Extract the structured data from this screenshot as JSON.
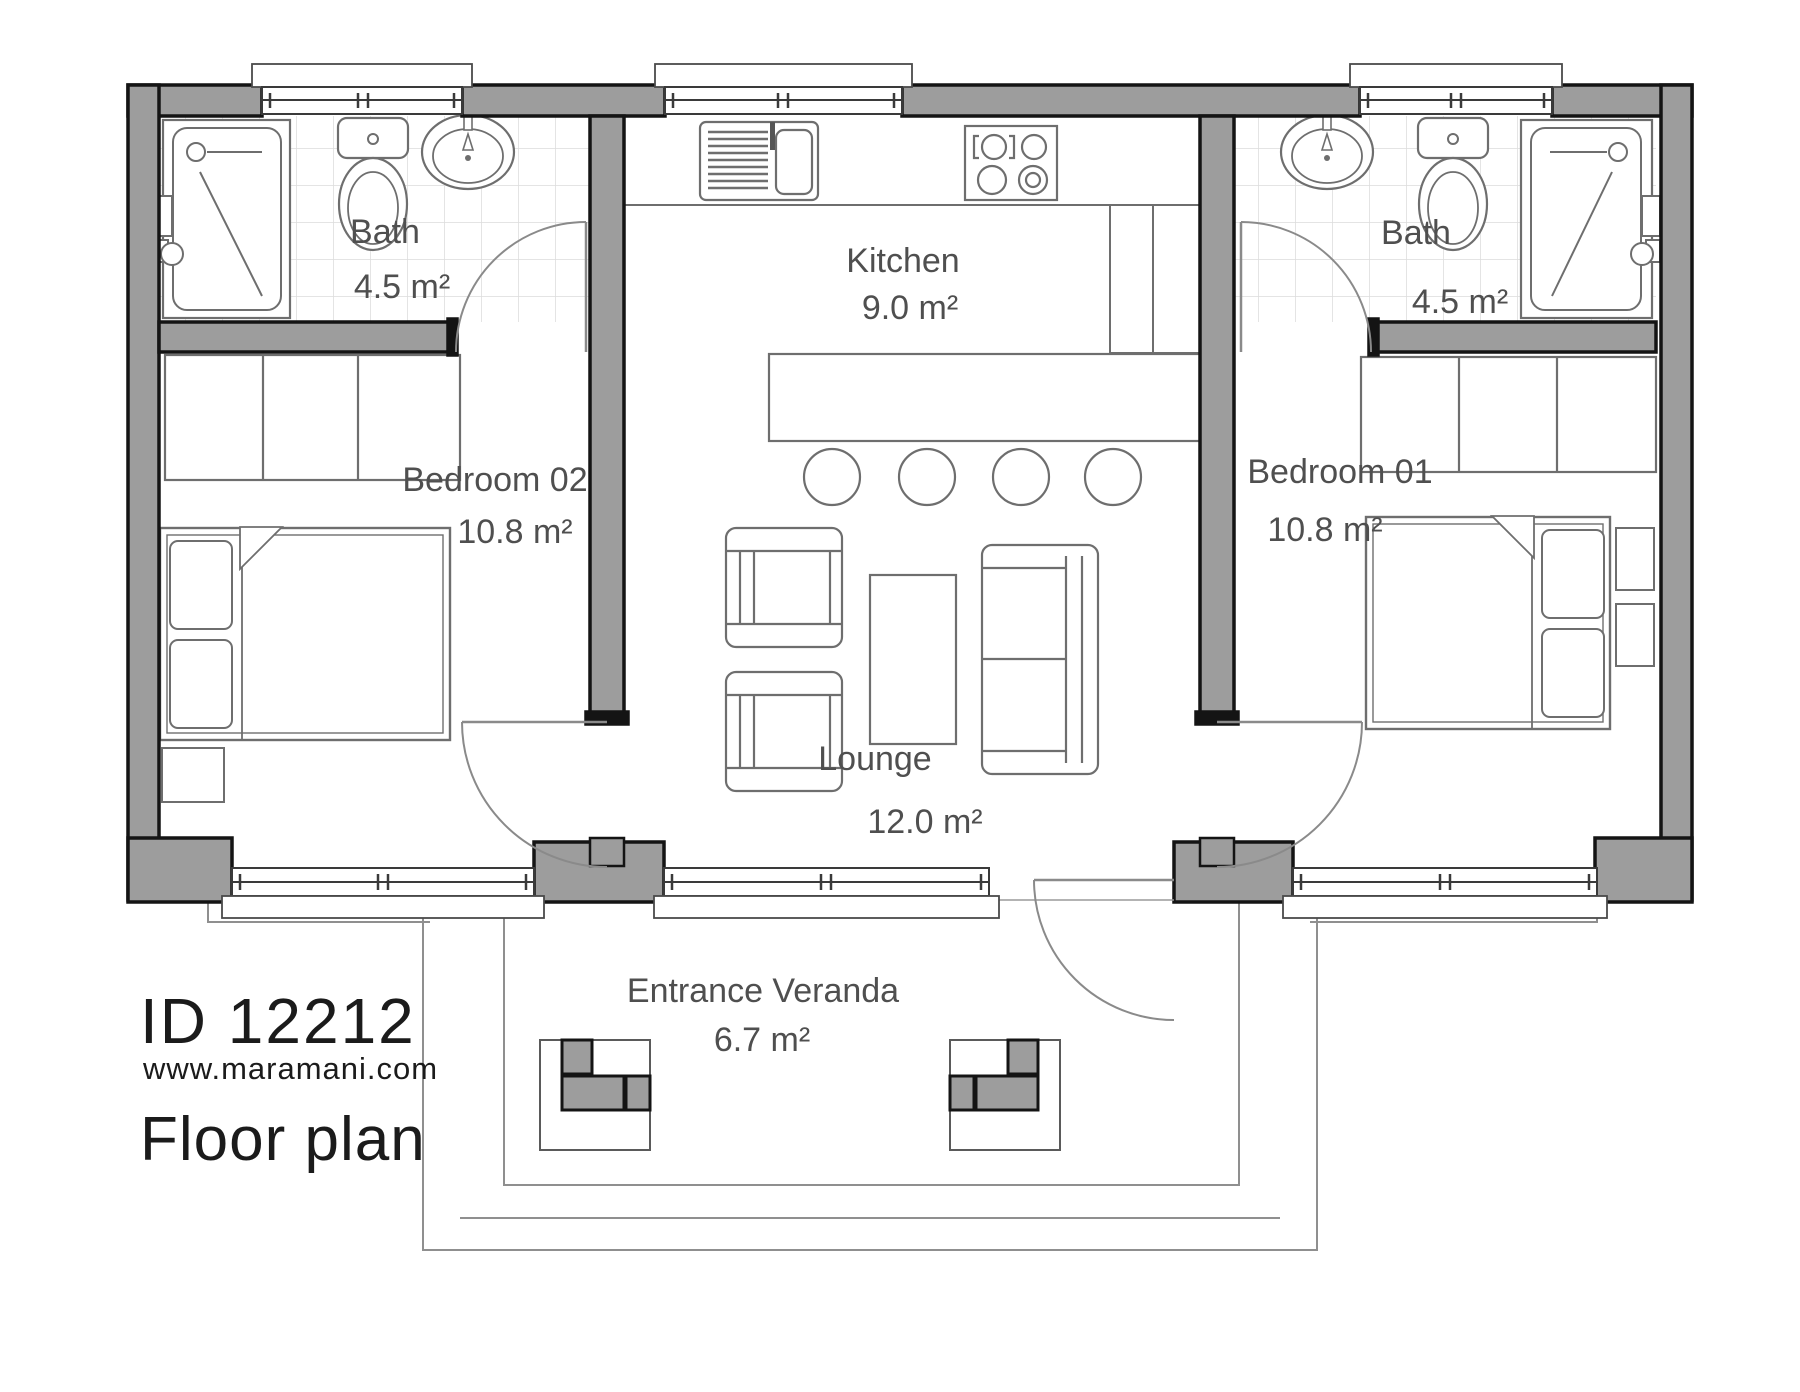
{
  "plan": {
    "brand": {
      "id_label": "ID 12212",
      "website": "www.maramani.com",
      "caption": "Floor plan"
    },
    "rooms": {
      "bath_left": {
        "name": "Bath",
        "area": "4.5 m²"
      },
      "kitchen": {
        "name": "Kitchen",
        "area": "9.0 m²"
      },
      "bath_right": {
        "name": "Bath",
        "area": "4.5 m²"
      },
      "bedroom_02": {
        "name": "Bedroom 02",
        "area": "10.8 m²"
      },
      "bedroom_01": {
        "name": "Bedroom 01",
        "area": "10.8 m²"
      },
      "lounge": {
        "name": "Lounge",
        "area": "12.0 m²"
      },
      "veranda": {
        "name": "Entrance Veranda",
        "area": "6.7 m²"
      }
    },
    "colors": {
      "wall_fill": "#9d9d9d",
      "wall_outline": "#141414",
      "furniture_line": "#6e6e6e",
      "door_line": "#8a8a8a",
      "tile_line": "#dcdcdc",
      "label_text": "#4f4f4f",
      "brand_text": "#1b1b1b"
    }
  }
}
